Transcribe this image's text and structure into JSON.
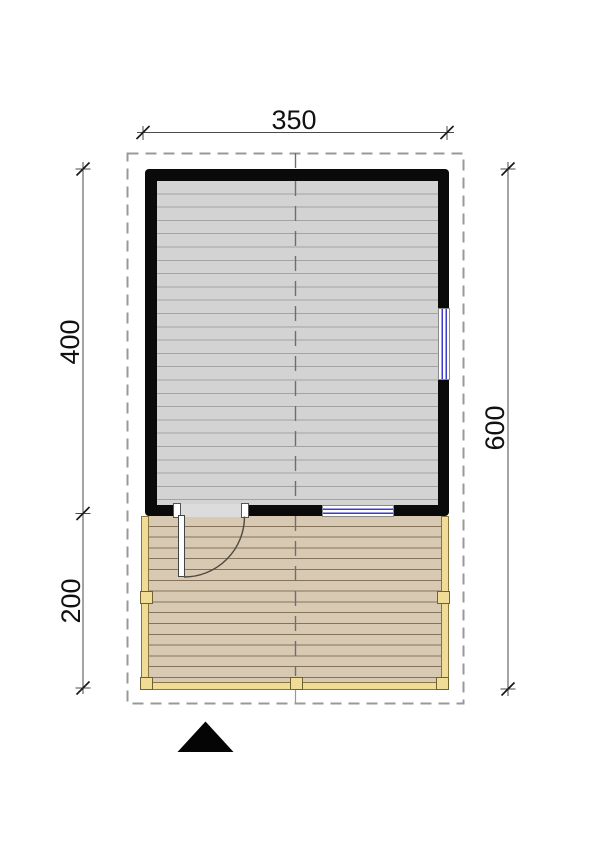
{
  "drawing": {
    "type_label": "floor-plan",
    "dimensions": {
      "top_width": "350",
      "room_depth": "400",
      "deck_depth": "200",
      "total_depth": "600"
    },
    "colors": {
      "wall": "#0a0a0a",
      "room_floor": "#d3d3d3",
      "room_plank_line": "#a3a3a3",
      "deck_floor": "#d7c9b2",
      "deck_plank_line": "#84735a",
      "deck_frame": "#f1dc97",
      "deck_frame_outline": "#86763f",
      "window_glazing": "#3b3bd0",
      "roof_outline": "#999999",
      "centerline": "#6e6e6e",
      "dimension_line": "#4a4a4a",
      "north_arrow": "#000000"
    },
    "icons": {
      "north_arrow": "north-arrow"
    }
  }
}
